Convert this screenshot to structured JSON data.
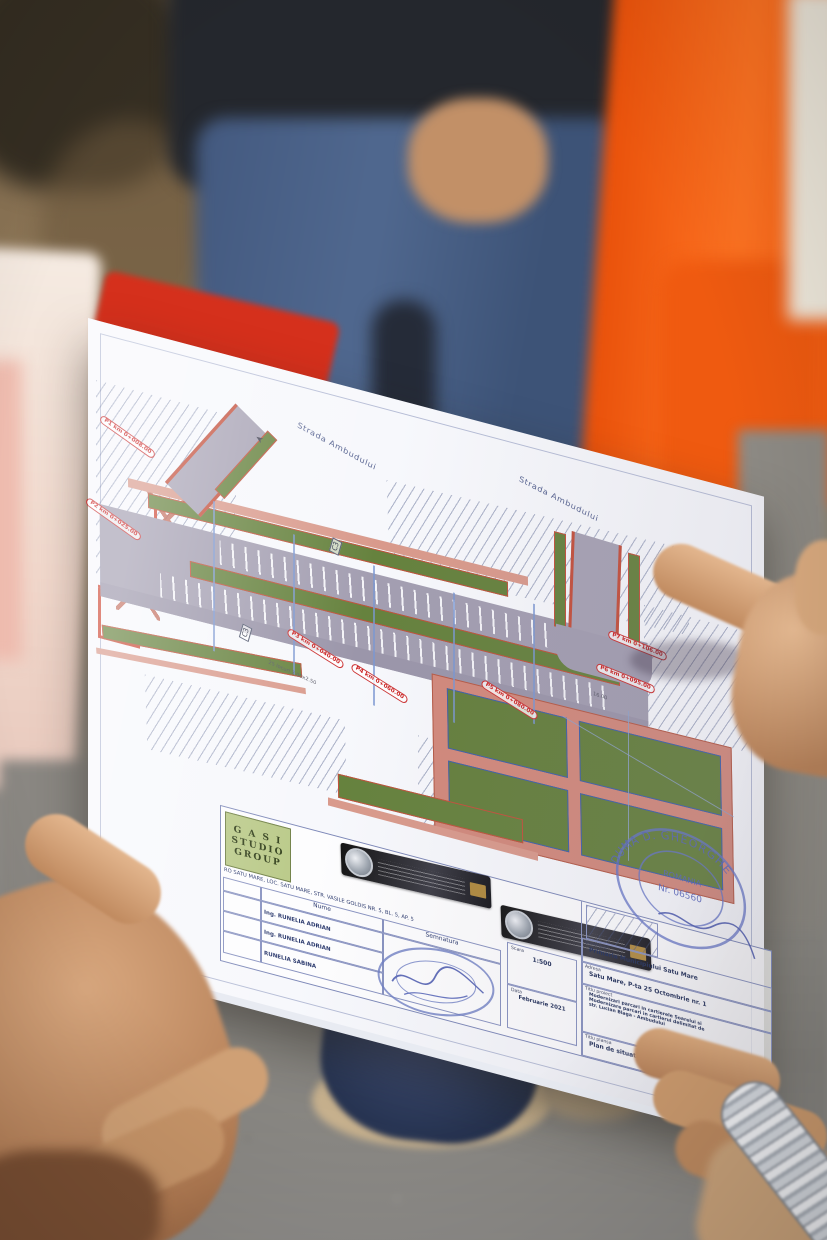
{
  "plan": {
    "street_label_1": "Strada Ambudului",
    "street_label_2": "Strada Ambudului",
    "markers": {
      "p1": "P1 km 0+008.00",
      "p2": "P2 km 0+025.00",
      "p3": "P3 km 0+040.00",
      "p4": "P4 km 0+060.00",
      "p5": "P5 km 0+080.00",
      "p6": "P6 km 0+095.00",
      "p7": "P7 km 0+106.00"
    },
    "section_label_a": "C3",
    "section_label_b": "C3",
    "parking_note": "25 locuri 3.00x2.50",
    "dim_note": "16.00"
  },
  "title_block": {
    "logo_line1": "G A S I",
    "logo_line2": "STUDIO",
    "logo_line3": "GROUP",
    "firm_line": "RO SATU MARE, LOC. SATU MARE, STR. VASILE GOLDIS NR. 5, BL. 5, AP. 5",
    "col_nume": "Nume",
    "col_semnatura": "Semnatura",
    "row1_name": "Ing. RUNELIA ADRIAN",
    "row2_name": "Ing. RUNELIA ADRIAN",
    "row3_name": "RUNELIA SABINA",
    "scara_label": "Scara",
    "scara_value": "1:500",
    "data_label": "Data",
    "data_value": "Februarie 2021",
    "beneficiar_label": "Beneficiar:",
    "beneficiar_value": "Primaria Municipiului Satu Mare",
    "adresa_label": "Adresa",
    "adresa_value": "Satu Mare, P-ta 25 Octombrie nr. 1",
    "proiect_label": "Titlu proiect",
    "proiect_line1": "Modernizari parcari in cartierele Soarelui si",
    "proiect_line2": "Modernizare parcari in cartierul delimitat de",
    "proiect_line3": "str. Lucian Blaga - Ambudului",
    "plansa_label": "Titlu plansa",
    "plansa_value": "Plan de situatie Curtea 3",
    "stamp_name": "DUMA D. GHEORGHE",
    "stamp_country": "ROMANIA",
    "stamp_nr": "Nr. 06560"
  }
}
